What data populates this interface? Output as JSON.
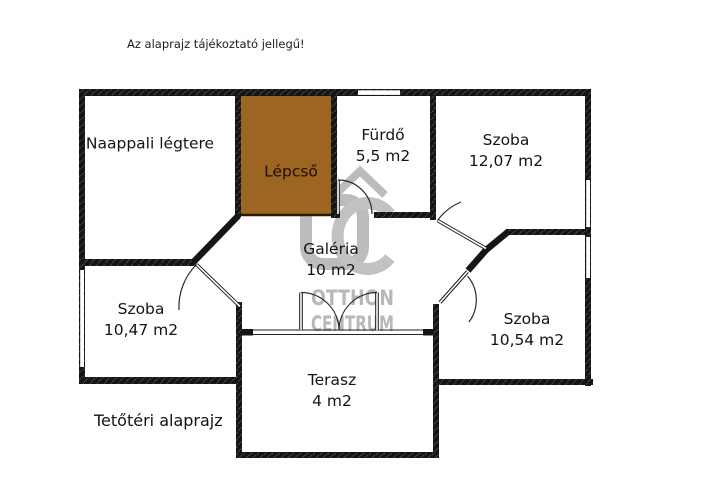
{
  "meta": {
    "disclaimer": "Az alaprajz tájékoztató jellegű!",
    "caption": "Tetőtéri alaprajz"
  },
  "rooms": {
    "naappali": {
      "name": "Naappali légtere"
    },
    "lepcso": {
      "name": "Lépcső"
    },
    "furdo": {
      "name": "Fürdő",
      "area": "5,5 m2"
    },
    "szoba_felso": {
      "name": "Szoba",
      "area": "12,07 m2"
    },
    "galeria": {
      "name": "Galéria",
      "area": "10 m2"
    },
    "szoba_bal": {
      "name": "Szoba",
      "area": "10,47 m2"
    },
    "szoba_jobb": {
      "name": "Szoba",
      "area": "10,54 m2"
    },
    "terasz": {
      "name": "Terasz",
      "area": "4 m2"
    }
  },
  "watermark": {
    "monogram": "OC",
    "line1": "OTTHON",
    "line2": "CENTRUM"
  },
  "colors": {
    "wall": "#151515",
    "stairs_fill": "#9c6522",
    "stairs_border": "#2b1804",
    "stairs_text": "#1d0f00",
    "watermark_gray": "#bcbcbc"
  }
}
